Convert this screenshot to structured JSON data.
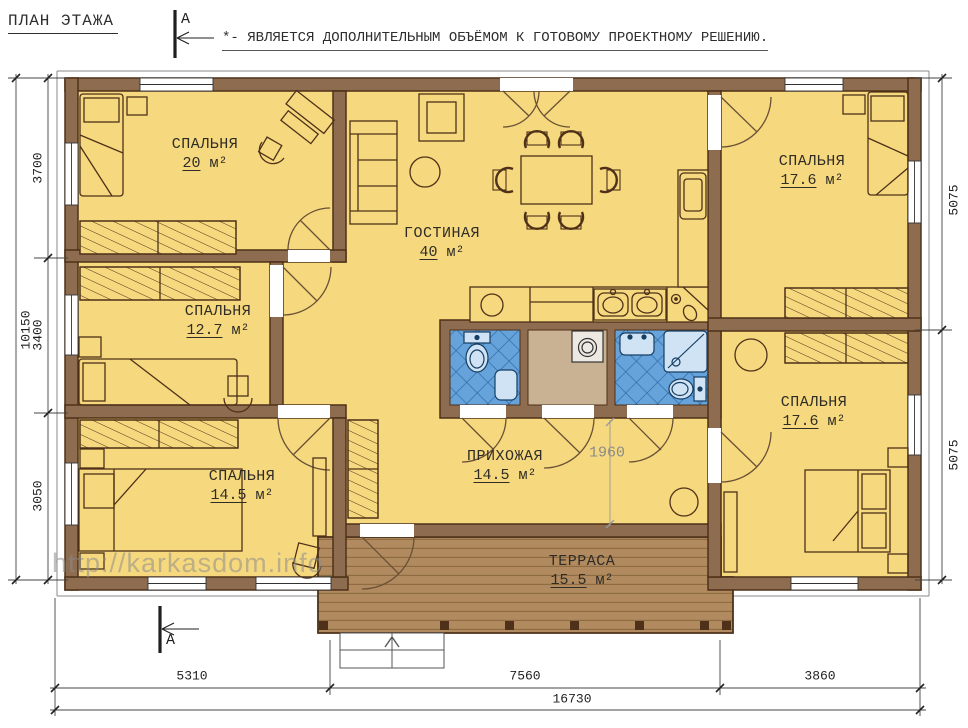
{
  "header": {
    "title": "ПЛАН ЭТАЖА",
    "note": "*- ЯВЛЯЕТСЯ ДОПОЛНИТЕЛЬНЫМ ОБЪЁМОМ К ГОТОВОМУ ПРОЕКТНОМУ РЕШЕНИЮ.",
    "section_label_top": "А",
    "section_label_bottom": "А"
  },
  "watermark": "http://karkasdom.info",
  "rooms": [
    {
      "id": "bedroom-top-left",
      "name": "СПАЛЬНЯ",
      "area": "20",
      "unit": "м²"
    },
    {
      "id": "bedroom-mid-left",
      "name": "СПАЛЬНЯ",
      "area": "12.7",
      "unit": "м²"
    },
    {
      "id": "bedroom-bot-left",
      "name": "СПАЛЬНЯ",
      "area": "14.5",
      "unit": "м²"
    },
    {
      "id": "living-room",
      "name": "ГОСТИНАЯ",
      "area": "40",
      "unit": "м²"
    },
    {
      "id": "hallway",
      "name": "ПРИХОЖАЯ",
      "area": "14.5",
      "unit": "м²"
    },
    {
      "id": "bedroom-top-right",
      "name": "СПАЛЬНЯ",
      "area": "17.6",
      "unit": "м²"
    },
    {
      "id": "bedroom-bot-right",
      "name": "СПАЛЬНЯ",
      "area": "17.6",
      "unit": "м²"
    },
    {
      "id": "terrace",
      "name": "ТЕРРАСА",
      "area": "15.5",
      "unit": "м²"
    }
  ],
  "dimensions": {
    "left_total": "10150",
    "left_chain": [
      "3700",
      "3400",
      "3050"
    ],
    "right_chain": [
      "5075",
      "5075"
    ],
    "bottom_chain": [
      "5310",
      "7560",
      "3860"
    ],
    "bottom_total": "16730",
    "hall_depth": "1960"
  },
  "colors": {
    "wall": "#8E6C50",
    "wall_outline": "#4e3118",
    "room_fill": "#F6D97E",
    "bath_tile": "#66A3DA",
    "bath_tile_line": "#2e6cab",
    "storage_fill": "#C9B193",
    "deck": "#B18A5F",
    "deck_line": "#8F6B42",
    "dim_gray": "#8a8a8a"
  }
}
